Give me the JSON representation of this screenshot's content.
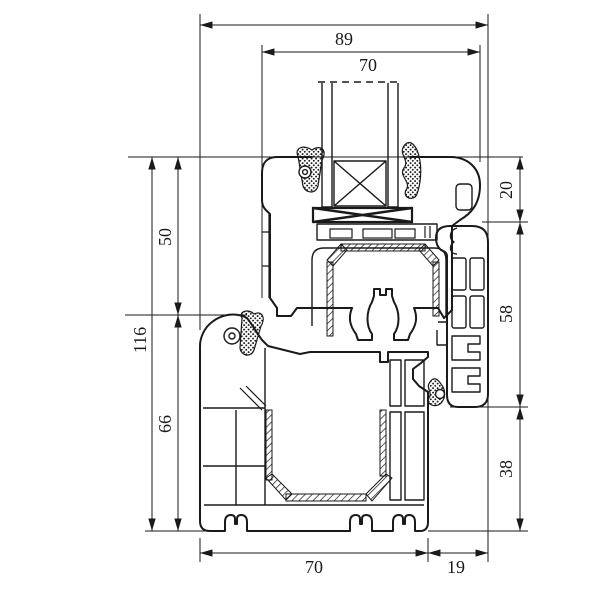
{
  "drawing": {
    "background_color": "#ffffff",
    "line_color": "#1a1a1a",
    "dimensions_mm": {
      "top_overall": "89",
      "top_sash": "70",
      "right_top": "20",
      "right_middle": "58",
      "right_bottom": "38",
      "left_upper": "50",
      "left_overall": "116",
      "left_lower": "66",
      "bottom_frame": "70",
      "bottom_flange": "19"
    }
  }
}
